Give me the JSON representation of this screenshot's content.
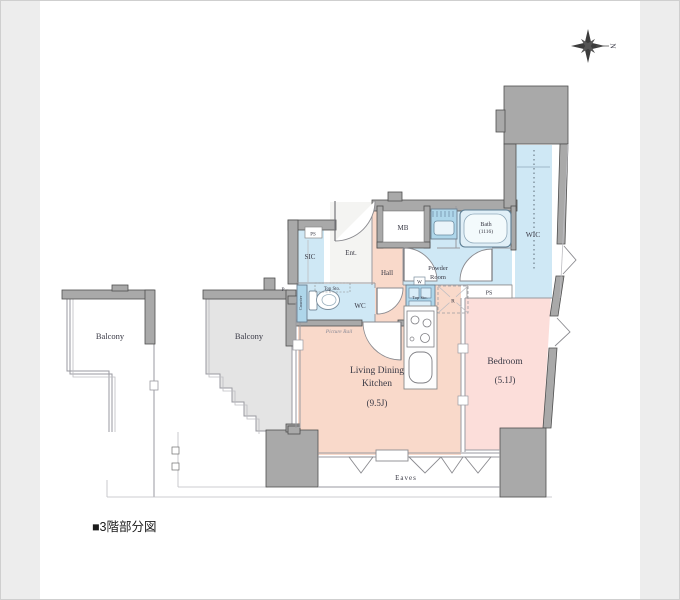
{
  "image": {
    "caption": "■3階部分図"
  },
  "compass": {
    "north_label": "N"
  },
  "rooms": {
    "balcony_left": "Balcony",
    "balcony_right": "Balcony",
    "sic": "SIC",
    "entrance": "Ent.",
    "meter_box": "MB",
    "hall": "Hall",
    "wc": "WC",
    "powder_line1": "Powder",
    "powder_line2": "Room",
    "bath_name": "Bath",
    "bath_size": "(1116)",
    "wic": "WIC",
    "ldk_line1": "Living Dining",
    "ldk_line2": "Kitchen",
    "ldk_size": "(9.5J)",
    "bedroom_name": "Bedroom",
    "bedroom_size": "(5.1J)",
    "eaves": "Eaves"
  },
  "fixtures": {
    "ps_entrance": "PS",
    "ps_bedroom": "PS",
    "pipe": "P",
    "wc_top_storage": "Top Sto.",
    "wc_counter": "Counter",
    "picture_rail": "Picture Rail",
    "laundry_storage": "Top Sto.",
    "washer": "W",
    "refrigerator": "R"
  },
  "colors": {
    "wall": "#a9a9a9",
    "wall_edge": "#4f4f4f",
    "block": "#b3b3b3",
    "room_pink": "#f9d9ca",
    "bedroom_pink": "#fcdeda",
    "room_blue": "#cfe8f5",
    "fixture_blue": "#aed6ea",
    "tub_blue": "#e0eff7",
    "balcony_gray": "#e4e4e4",
    "paper": "#ffffff"
  }
}
